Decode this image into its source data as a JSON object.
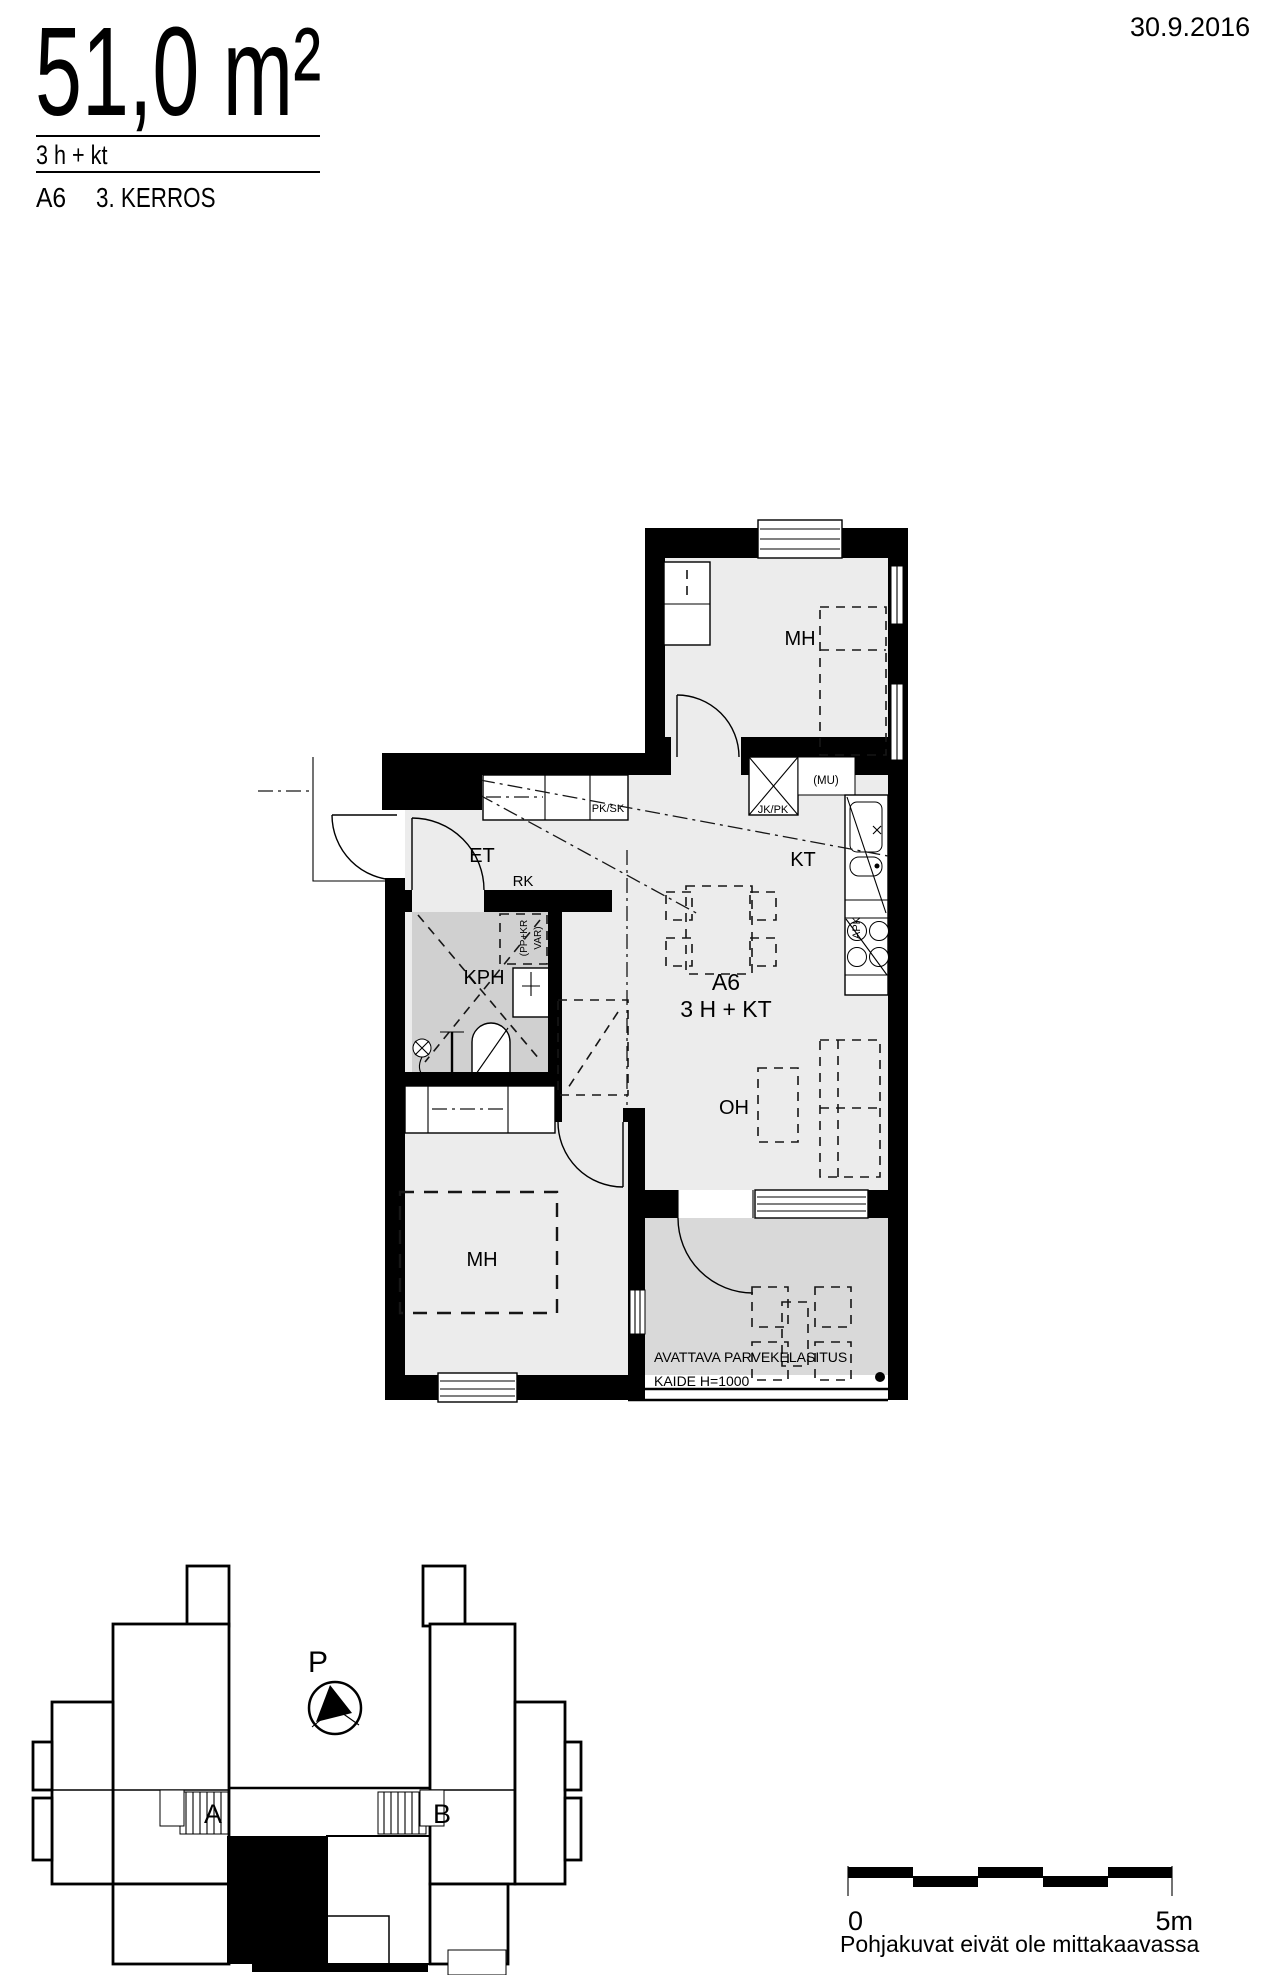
{
  "header": {
    "area": "51,0 m²",
    "configuration": "3 h + kt",
    "apartment_id": "A6",
    "floor": "3. KERROS",
    "date": "30.9.2016"
  },
  "floor_plan": {
    "unit_label": "A6",
    "unit_type": "3 H + KT",
    "rooms": {
      "bedroom_top": "MH",
      "entry": "ET",
      "kitchen": "KT",
      "bathroom": "KPH",
      "living_room": "OH",
      "bedroom_bottom": "MH"
    },
    "fixtures": {
      "hall_cabinet": "PK/SK",
      "fridge_freezer": "JK/PK",
      "microwave_reservation": "(MU)",
      "dishwasher": "APK",
      "rk_closet": "RK",
      "washer_dryer_line1": "(PP+KR",
      "washer_dryer_line2": "VAR)"
    },
    "balcony": {
      "note_line1": "AVATTAVA PARVEKELASITUS",
      "note_line2": "KAIDE H=1000"
    }
  },
  "site_plan": {
    "north": "P",
    "stairwell_a": "A",
    "stairwell_b": "B"
  },
  "scale_bar": {
    "start": "0",
    "end": "5m"
  },
  "footer": {
    "note": "Pohjakuvat eivät ole mittakaavassa"
  }
}
